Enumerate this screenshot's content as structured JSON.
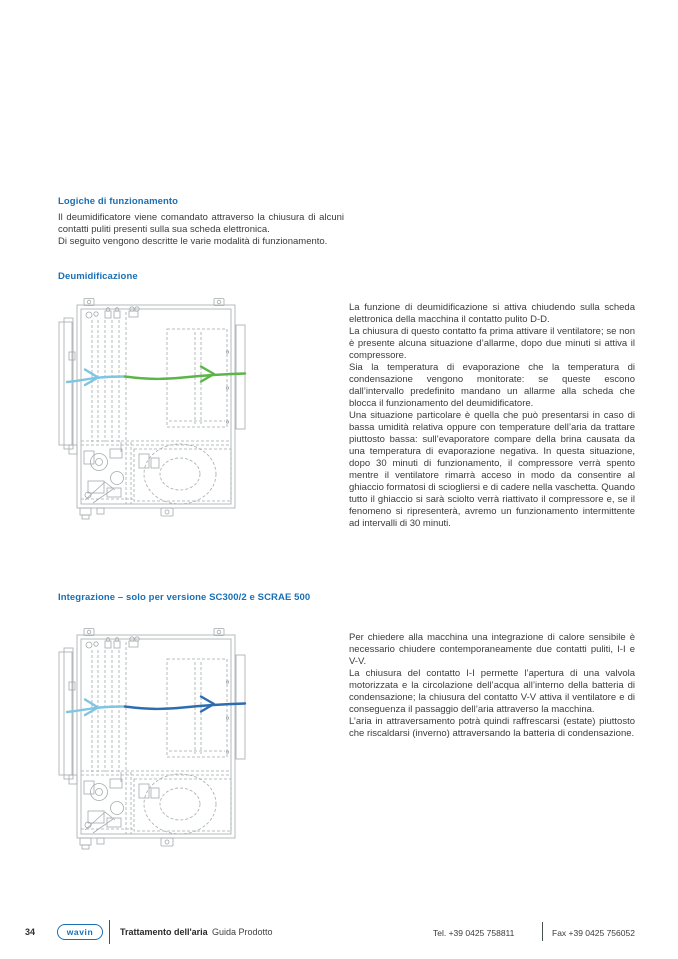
{
  "colors": {
    "heading": "#1a6fb5",
    "body": "#3b3b3b",
    "drawing": "#a3abac"
  },
  "intro": {
    "heading": "Logiche di funzionamento",
    "paragraphs": [
      "Il deumidificatore viene comandato attraverso la chiusura di alcuni contatti puliti presenti sulla sua scheda elettronica.",
      "Di seguito vengono descritte le varie modalità di funzionamento."
    ]
  },
  "dehumidification": {
    "heading": "Deumidificazione",
    "paragraphs": [
      "La funzione di deumidificazione si attiva chiudendo sulla scheda elettronica della macchina il contatto pulito D-D.",
      "La chiusura di questo contatto fa prima attivare il ventilatore; se non è presente alcuna situazione d’allarme, dopo due minuti si attiva il compressore.",
      "Sia la temperatura di evaporazione che la temperatura di condensazione vengono monitorate: se queste escono dall’intervallo predefinito mandano un allarme alla scheda che blocca il funzionamento del deumidificatore.",
      "Una situazione particolare è quella che può presentarsi in caso di bassa umidità relativa oppure con temperature dell’aria da trattare piuttosto bassa: sull’evaporatore compare della brina causata da una temperatura di evaporazione negativa. In questa situazione, dopo 30 minuti di funzionamento, il compressore verrà spento mentre il ventilatore rimarrà acceso in modo da consentire al ghiaccio formatosi di sciogliersi e di cadere nella vaschetta. Quando tutto il ghiaccio si sarà sciolto verrà riattivato il compressore e, se il fenomeno si ripresenterà, avremo un funzionamento intermittente ad intervalli di 30 minuti."
    ],
    "diagram": {
      "description": "airflow-through-dehumidifier-unit",
      "arrow_in_color": "#7fc5e2",
      "arrow_out_color": "#5cb547"
    }
  },
  "integration": {
    "heading": "Integrazione – solo per versione SC300/2 e SCRAE 500",
    "paragraphs": [
      "Per chiedere alla macchina una integrazione di calore sensibile è necessario chiudere contemporaneamente due contatti puliti, I-I e V-V.",
      "La chiusura del contatto I-I permette l’apertura di una valvola motorizzata e la circolazione dell’acqua all’interno della batteria di condensazione; la chiusura del contatto V-V attiva il ventilatore e di conseguenza il passaggio dell’aria attraverso la macchina.",
      "L’aria in attraversamento potrà quindi raffrescarsi (estate) piuttosto che riscaldarsi (inverno) attraversando la batteria di condensazione."
    ],
    "diagram": {
      "description": "airflow-through-integration-unit",
      "arrow_in_color": "#7fc5e2",
      "arrow_out_color": "#2e6cb2"
    }
  },
  "footer": {
    "page_number": "34",
    "brand": "wavin",
    "doc_title": "Trattamento dell'aria",
    "doc_subtitle": "Guida Prodotto",
    "tel": "Tel. +39 0425 758811",
    "fax": "Fax +39 0425 756052"
  }
}
